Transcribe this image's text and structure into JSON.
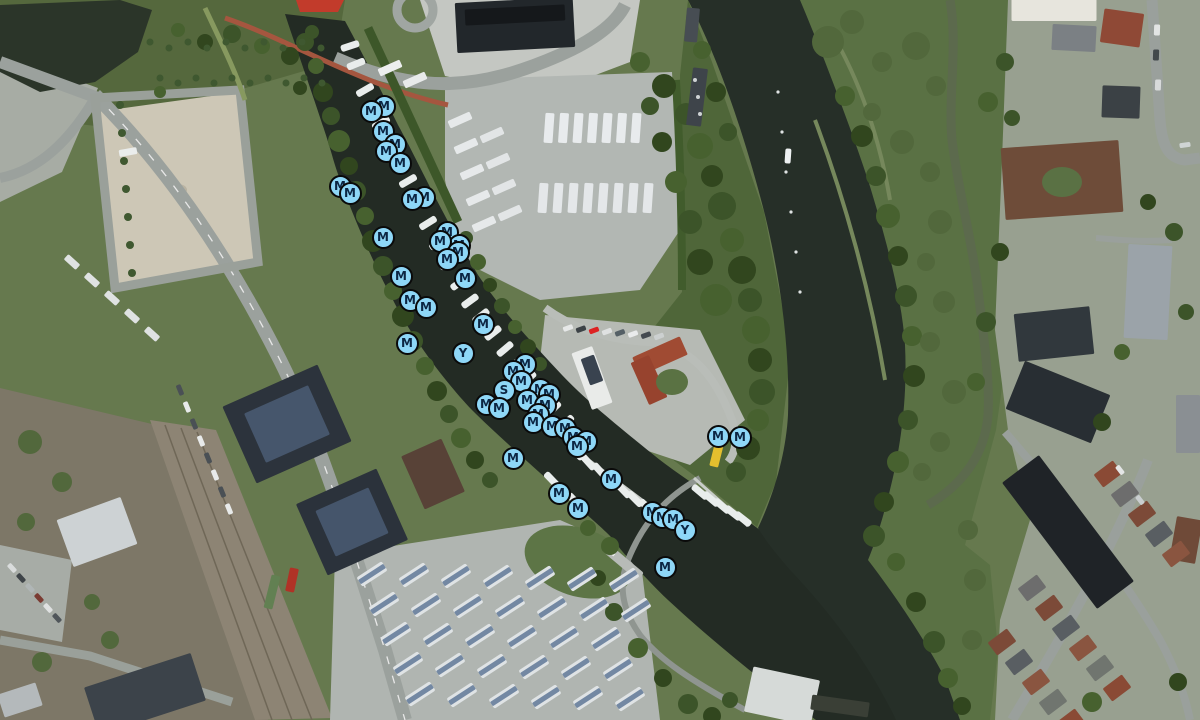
{
  "map": {
    "view": "aerial-satellite",
    "marker_style": {
      "fill": "#8ed7f7",
      "ring": "#0a0a0a",
      "text_color": "#0c2643",
      "diameter_px": 23
    },
    "marker_letters_visible": [
      "M",
      "Y",
      "S"
    ],
    "markers": [
      {
        "x": 384,
        "y": 106,
        "l": "M"
      },
      {
        "x": 371,
        "y": 111,
        "l": "M"
      },
      {
        "x": 383,
        "y": 131,
        "l": "M"
      },
      {
        "x": 395,
        "y": 144,
        "l": "M"
      },
      {
        "x": 386,
        "y": 151,
        "l": "M"
      },
      {
        "x": 400,
        "y": 163,
        "l": "M"
      },
      {
        "x": 340,
        "y": 186,
        "l": "M"
      },
      {
        "x": 350,
        "y": 193,
        "l": "M"
      },
      {
        "x": 424,
        "y": 197,
        "l": "M"
      },
      {
        "x": 412,
        "y": 199,
        "l": "M"
      },
      {
        "x": 383,
        "y": 237,
        "l": "M"
      },
      {
        "x": 447,
        "y": 232,
        "l": "M"
      },
      {
        "x": 459,
        "y": 245,
        "l": "M"
      },
      {
        "x": 440,
        "y": 241,
        "l": "M"
      },
      {
        "x": 458,
        "y": 252,
        "l": "M"
      },
      {
        "x": 447,
        "y": 259,
        "l": "M"
      },
      {
        "x": 401,
        "y": 276,
        "l": "M"
      },
      {
        "x": 465,
        "y": 278,
        "l": "M"
      },
      {
        "x": 410,
        "y": 300,
        "l": "M"
      },
      {
        "x": 426,
        "y": 307,
        "l": "M"
      },
      {
        "x": 483,
        "y": 324,
        "l": "M"
      },
      {
        "x": 407,
        "y": 343,
        "l": "M"
      },
      {
        "x": 463,
        "y": 353,
        "l": "Y"
      },
      {
        "x": 525,
        "y": 364,
        "l": "M"
      },
      {
        "x": 513,
        "y": 371,
        "l": "M"
      },
      {
        "x": 521,
        "y": 381,
        "l": "M"
      },
      {
        "x": 504,
        "y": 390,
        "l": "S"
      },
      {
        "x": 540,
        "y": 389,
        "l": "M"
      },
      {
        "x": 549,
        "y": 394,
        "l": "M"
      },
      {
        "x": 527,
        "y": 400,
        "l": "M"
      },
      {
        "x": 486,
        "y": 404,
        "l": "M"
      },
      {
        "x": 499,
        "y": 408,
        "l": "M"
      },
      {
        "x": 545,
        "y": 405,
        "l": "M"
      },
      {
        "x": 538,
        "y": 414,
        "l": "M"
      },
      {
        "x": 533,
        "y": 422,
        "l": "M"
      },
      {
        "x": 552,
        "y": 426,
        "l": "M"
      },
      {
        "x": 565,
        "y": 428,
        "l": "M"
      },
      {
        "x": 573,
        "y": 437,
        "l": "M"
      },
      {
        "x": 586,
        "y": 441,
        "l": "M"
      },
      {
        "x": 577,
        "y": 446,
        "l": "M"
      },
      {
        "x": 513,
        "y": 458,
        "l": "M"
      },
      {
        "x": 611,
        "y": 479,
        "l": "M"
      },
      {
        "x": 559,
        "y": 493,
        "l": "M"
      },
      {
        "x": 578,
        "y": 508,
        "l": "M"
      },
      {
        "x": 652,
        "y": 512,
        "l": "M"
      },
      {
        "x": 662,
        "y": 517,
        "l": "M"
      },
      {
        "x": 673,
        "y": 519,
        "l": "M"
      },
      {
        "x": 685,
        "y": 530,
        "l": "Y"
      },
      {
        "x": 665,
        "y": 567,
        "l": "M"
      },
      {
        "x": 718,
        "y": 436,
        "l": "M"
      },
      {
        "x": 740,
        "y": 437,
        "l": "M"
      }
    ]
  }
}
